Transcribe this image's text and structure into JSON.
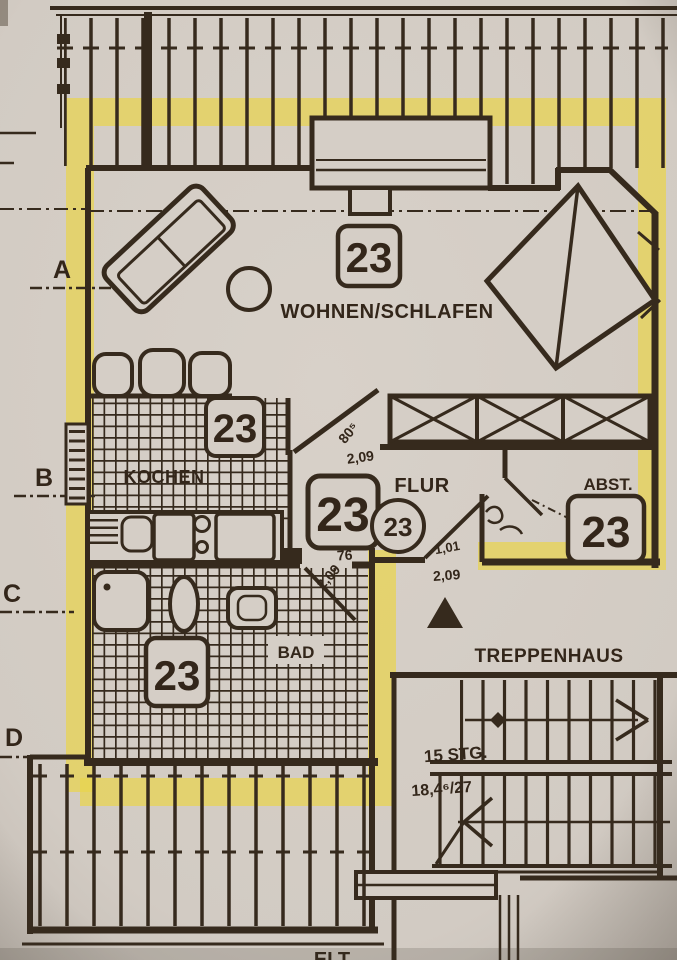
{
  "document": {
    "type_label": "apartment floor plan"
  },
  "rooms": {
    "living": {
      "label": "WOHNEN/SCHLAFEN",
      "unit": "23"
    },
    "kitchen": {
      "label": "KOCHEN",
      "unit": "23"
    },
    "hall": {
      "label": "FLUR",
      "unit": "23",
      "unit_circle": "23"
    },
    "storage": {
      "label": "ABST.",
      "unit": "23"
    },
    "bath": {
      "label": "BAD",
      "unit": "23"
    },
    "stairwell": {
      "label": "TREPPENHAUS",
      "steps_count": "15 STG.",
      "step_ratio": "18,4⁶/27"
    }
  },
  "dimensions": {
    "hall_opening_width": "80⁵",
    "hall_length": "2,09",
    "hall_door_width": "76",
    "bath_door": "2,09",
    "entry_width": "1,01",
    "entry_height": "2,09"
  },
  "section_markers": {
    "a": "A",
    "b": "B",
    "c": "C",
    "d": "D"
  },
  "edge_text": {
    "bottom_partial": "ELT"
  },
  "colors": {
    "paper": "#d5cec6",
    "ink": "#362a1d",
    "highlight": "#e9d44e"
  }
}
